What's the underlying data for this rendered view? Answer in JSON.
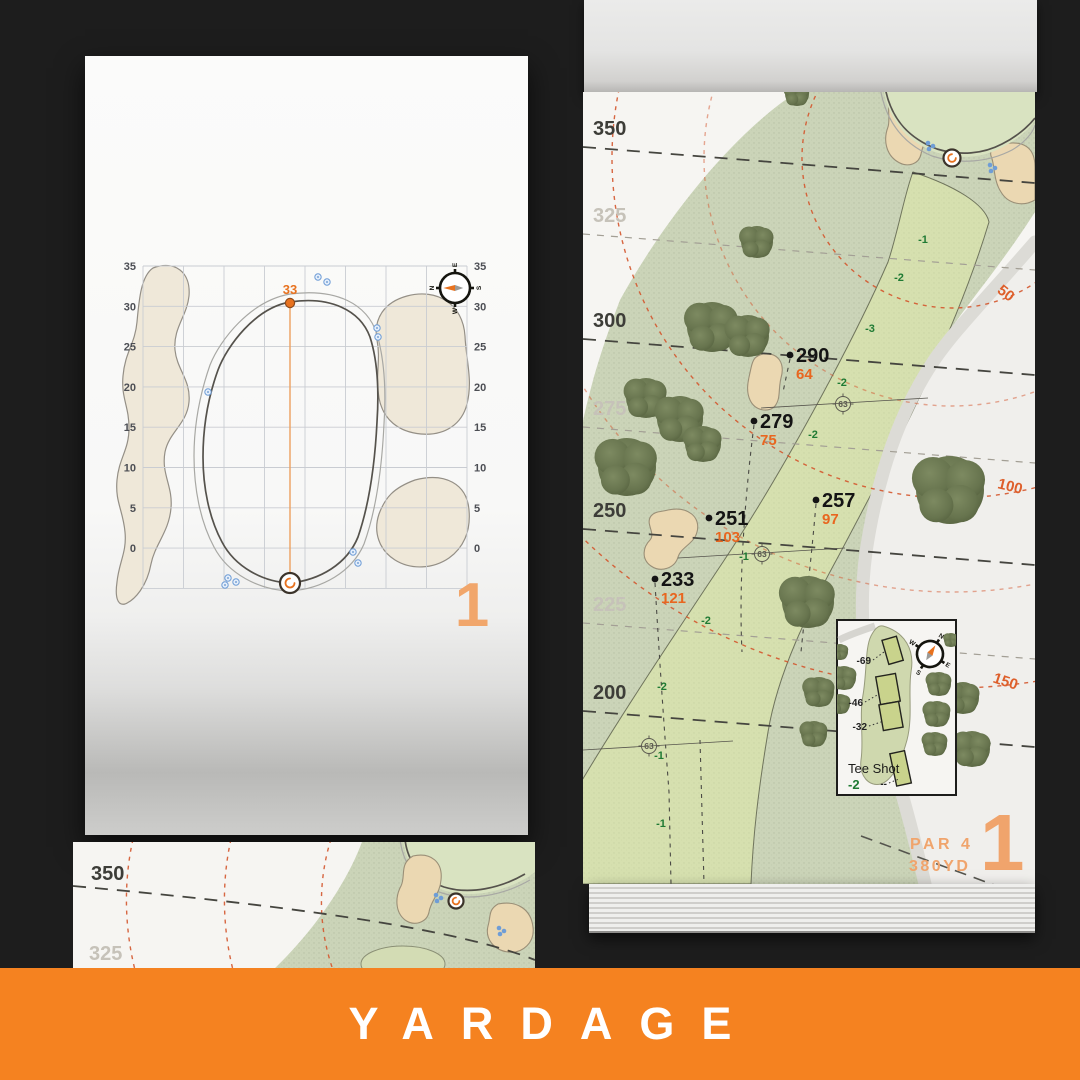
{
  "banner": {
    "label": "YARDAGE"
  },
  "colors": {
    "banner_orange": "#F58220",
    "accent_orange": "#E8721F",
    "soft_orange": "#F0A46C",
    "arc_orange": "#D4562E",
    "elevation_green": "#1F7A33",
    "major_label": "#3D3D38",
    "minor_label": "#C6C2B9",
    "sand": "#EBD8B2",
    "rough_green": "#CBD4B8",
    "fairway_green": "#D6E0AF",
    "tree_green": "#67744E",
    "sprinkler_blue": "#6F9DD6"
  },
  "left_page": {
    "green_chart": {
      "hole_number": "1",
      "pin_distance_label": "33",
      "axis_ticks": [
        "35",
        "30",
        "25",
        "20",
        "15",
        "10",
        "5",
        "0"
      ],
      "compass_points": [
        "N",
        "E",
        "S",
        "W"
      ]
    }
  },
  "right_page": {
    "hole_map": {
      "distance_lines": [
        {
          "label": "350",
          "major": true
        },
        {
          "label": "325",
          "major": false
        },
        {
          "label": "300",
          "major": true
        },
        {
          "label": "275",
          "major": false
        },
        {
          "label": "250",
          "major": true
        },
        {
          "label": "225",
          "major": false
        },
        {
          "label": "200",
          "major": true
        }
      ],
      "arc_distance_labels": [
        "50",
        "100",
        "150"
      ],
      "carry_markers": [
        {
          "carry": "290",
          "remaining": "64"
        },
        {
          "carry": "279",
          "remaining": "75"
        },
        {
          "carry": "257",
          "remaining": "97"
        },
        {
          "carry": "251",
          "remaining": "103"
        },
        {
          "carry": "233",
          "remaining": "121"
        }
      ],
      "elevation_labels": [
        "-1",
        "-2",
        "-3",
        "-2",
        "-2",
        "-1",
        "-2",
        "-2",
        "-1",
        "-1"
      ],
      "sprinkler_head_values": [
        "63",
        "63",
        "63"
      ],
      "tee_inset": {
        "title": "Tee Shot",
        "elevation": "-2",
        "tee_offsets": [
          "-69",
          "-46",
          "-32",
          "--"
        ],
        "compass_points": [
          "N",
          "E",
          "S",
          "W"
        ]
      },
      "hole_info": {
        "par": "PAR 4",
        "distance": "380YD",
        "hole_number": "1"
      }
    }
  },
  "bottom_left_page": {
    "distance_lines": [
      {
        "label": "350",
        "major": true
      },
      {
        "label": "325",
        "major": false
      }
    ]
  }
}
